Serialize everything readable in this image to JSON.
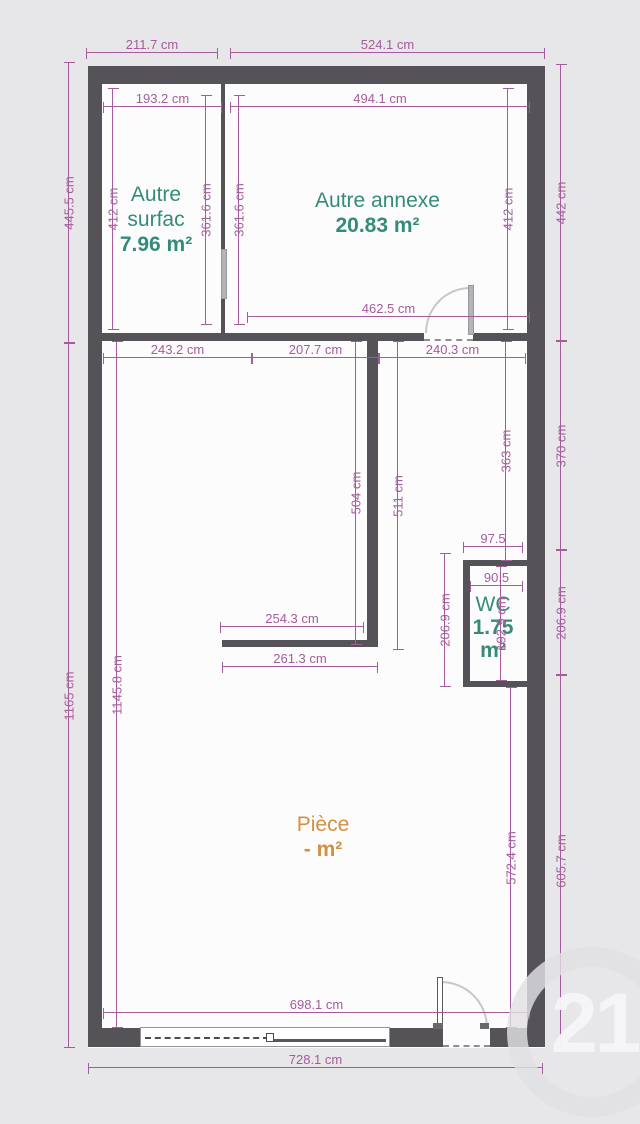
{
  "plan": {
    "rooms": {
      "autre_surface": {
        "lines": [
          "Autre",
          "surfac",
          "7.96 m²"
        ]
      },
      "autre_annexe": {
        "lines": [
          "Autre annexe",
          "20.83 m²"
        ]
      },
      "wc": {
        "lines": [
          "WC",
          "1.75",
          "m²"
        ]
      },
      "piece": {
        "lines": [
          "Pièce",
          "- m²"
        ]
      }
    },
    "dimensions": [
      {
        "label": "211.7 cm",
        "orient": "h",
        "x": 86,
        "y": 52,
        "len": 132
      },
      {
        "label": "524.1 cm",
        "orient": "h",
        "x": 230,
        "y": 52,
        "len": 315
      },
      {
        "label": "193.2 cm",
        "orient": "h",
        "x": 103,
        "y": 106,
        "len": 119
      },
      {
        "label": "494.1 cm",
        "orient": "h",
        "x": 230,
        "y": 106,
        "len": 300
      },
      {
        "label": "462.5 cm",
        "orient": "h",
        "x": 247,
        "y": 316,
        "len": 283
      },
      {
        "label": "243.2 cm",
        "orient": "h",
        "x": 103,
        "y": 357,
        "len": 149
      },
      {
        "label": "207.7 cm",
        "orient": "h",
        "x": 252,
        "y": 357,
        "len": 127
      },
      {
        "label": "240.3 cm",
        "orient": "h",
        "x": 379,
        "y": 357,
        "len": 147
      },
      {
        "label": "97.5",
        "orient": "h",
        "x": 463,
        "y": 546,
        "len": 60
      },
      {
        "label": "90.5",
        "orient": "h",
        "x": 470,
        "y": 585,
        "len": 53
      },
      {
        "label": "254.3 cm",
        "orient": "h",
        "x": 220,
        "y": 626,
        "len": 144
      },
      {
        "label": "261.3 cm",
        "orient": "h",
        "x": 222,
        "y": 666,
        "len": 156
      },
      {
        "label": "698.1 cm",
        "orient": "h",
        "x": 103,
        "y": 1012,
        "len": 427
      },
      {
        "label": "728.1 cm",
        "orient": "h",
        "x": 88,
        "y": 1067,
        "len": 455
      },
      {
        "label": "445.5 cm",
        "orient": "v",
        "x": 68,
        "y": 62,
        "len": 281
      },
      {
        "label": "412 cm",
        "orient": "v",
        "x": 112,
        "y": 88,
        "len": 242
      },
      {
        "label": "361.6 cm",
        "orient": "v",
        "x": 205,
        "y": 95,
        "len": 230
      },
      {
        "label": "361.6 cm",
        "orient": "v",
        "x": 238,
        "y": 95,
        "len": 230
      },
      {
        "label": "412 cm",
        "orient": "v",
        "x": 507,
        "y": 88,
        "len": 242
      },
      {
        "label": "442 cm",
        "orient": "v",
        "x": 560,
        "y": 64,
        "len": 277
      },
      {
        "label": "1165 cm",
        "orient": "v",
        "x": 68,
        "y": 343,
        "len": 705
      },
      {
        "label": "1145.8 cm",
        "orient": "v",
        "x": 116,
        "y": 341,
        "len": 687
      },
      {
        "label": "504 cm",
        "orient": "v",
        "x": 355,
        "y": 341,
        "len": 304
      },
      {
        "label": "511 cm",
        "orient": "v",
        "x": 397,
        "y": 341,
        "len": 309
      },
      {
        "label": "363 cm",
        "orient": "v",
        "x": 505,
        "y": 341,
        "len": 220
      },
      {
        "label": "370 cm",
        "orient": "v",
        "x": 560,
        "y": 341,
        "len": 209
      },
      {
        "label": "206.9 cm",
        "orient": "v",
        "x": 444,
        "y": 553,
        "len": 134
      },
      {
        "label": "192.9 cm",
        "orient": "v",
        "x": 500,
        "y": 566,
        "len": 115
      },
      {
        "label": "206.9 cm",
        "orient": "v",
        "x": 560,
        "y": 550,
        "len": 125
      },
      {
        "label": "572.4 cm",
        "orient": "v",
        "x": 510,
        "y": 687,
        "len": 341
      },
      {
        "label": "605.7 cm",
        "orient": "v",
        "x": 560,
        "y": 675,
        "len": 372
      }
    ]
  },
  "watermark": {
    "text": "21"
  },
  "colors": {
    "background": "#e7e6e9",
    "floor": "#fcfcfd",
    "wall": "#565358",
    "dimension": "#a55c9d",
    "room_green": "#348c78",
    "room_orange": "#d29140",
    "watermark": "#dedde0"
  }
}
